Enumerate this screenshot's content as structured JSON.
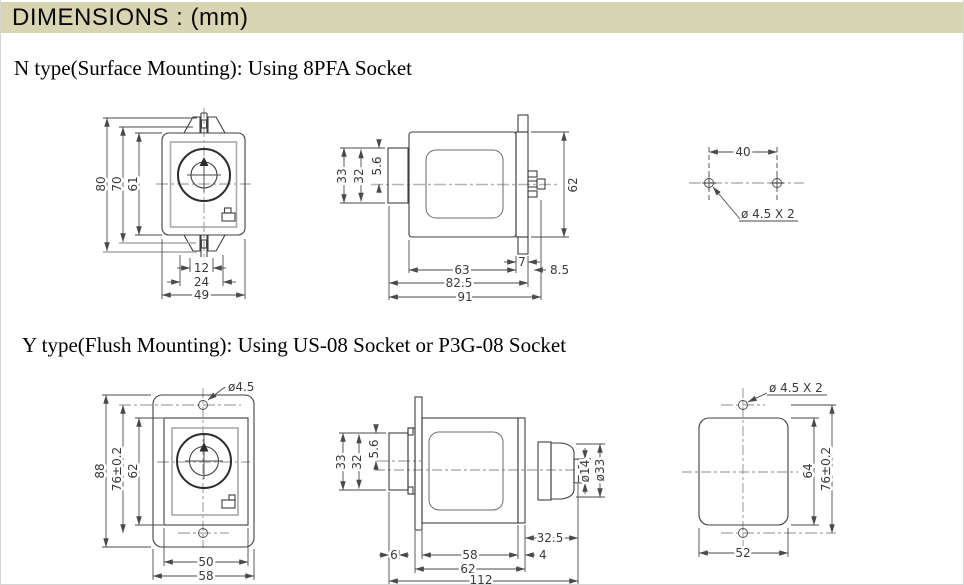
{
  "header": {
    "title": "DIMENSIONS : (mm)"
  },
  "colors": {
    "header_bg": "#d8d5b2",
    "line": "#3f3f3f",
    "dim": "#4a4a4a",
    "centerline": "#b4b4b4"
  },
  "n_type": {
    "heading": "N type(Surface Mounting): Using 8PFA Socket",
    "front_view": {
      "overall_height": "80",
      "hook_span": "70",
      "body_height": "61",
      "notch_width": "12",
      "hook_width": "24",
      "body_width": "49"
    },
    "side_view": {
      "knob_dia": "33",
      "knob_inner": "32",
      "knob_offset": "5.6",
      "body_height": "62",
      "body_depth": "63",
      "bracket_depth": "7",
      "pin_depth": "8.5",
      "depth_with_bracket": "82.5",
      "overall_depth": "91"
    },
    "mounting_holes": {
      "pitch": "40",
      "hole_note": "ø 4.5 X 2"
    }
  },
  "y_type": {
    "heading": "Y type(Flush Mounting): Using US-08 Socket or P3G-08 Socket",
    "front_view": {
      "hole_note": "ø4.5",
      "overall_height": "88",
      "hole_pitch": "76±0.2",
      "body_height": "62",
      "body_width": "50",
      "flange_width": "58"
    },
    "side_view": {
      "knob_dia": "33",
      "knob_inner": "32",
      "knob_offset": "5.6",
      "plug_dia": "ø14",
      "socket_dia": "ø33",
      "socket_depth": "32.5",
      "knob_depth": "6",
      "body_depth": "58",
      "plate_depth": "4",
      "flange_to_plate": "62",
      "overall_depth": "112"
    },
    "panel_cutout": {
      "hole_note": "ø 4.5 X 2",
      "cutout_height": "64",
      "hole_pitch": "76±0.2",
      "cutout_width": "52"
    }
  }
}
